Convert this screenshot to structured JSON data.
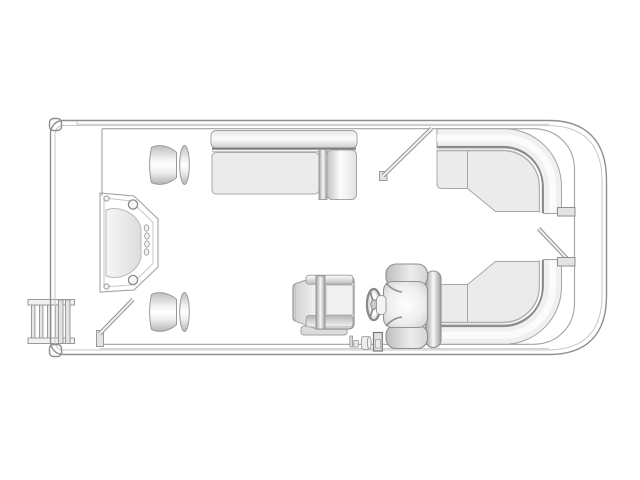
{
  "title": "Pontoon boat deck floor plan (top-down line drawing)",
  "colors": {
    "background": "#ffffff",
    "deck": "#e8e9ea",
    "outline": "#8f8f8f",
    "outline_light": "#c6c8ca",
    "fence": "#a2a2a2",
    "seam": "#8a8a8a",
    "seat": "#ebebec",
    "cushion_base": "#f0f0f0",
    "cushion_highlight": "#fbfbfb",
    "panel": "#e3e3e3"
  },
  "components": [
    {
      "name": "hull",
      "desc": "pontoon deck outline, bow at left, stern at right"
    },
    {
      "name": "boarding-ladder",
      "desc": "four-rung boarding ladder outside bow port corner"
    },
    {
      "name": "bow-gate-door",
      "desc": "bow gate panel with hinge bolts and vent slots"
    },
    {
      "name": "bow-gate-open",
      "desc": "open gate shown swung at starboard bow"
    },
    {
      "name": "pedestal-table-forward",
      "desc": "pedestal seat/table, forward"
    },
    {
      "name": "pedestal-table-aft",
      "desc": "pedestal seat/table, aft of bow door"
    },
    {
      "name": "port-bench-lounge",
      "desc": "straight bench with chaise end along forward port side"
    },
    {
      "name": "port-aft-gate-open",
      "desc": "open side gate ahead of stern lounge"
    },
    {
      "name": "stern-lounge-top",
      "desc": "wraparound corner lounge, stern port quarter"
    },
    {
      "name": "stern-lounge-bottom",
      "desc": "wraparound corner lounge, stern starboard quarter"
    },
    {
      "name": "stern-gate-open",
      "desc": "open stern gate between lounges"
    },
    {
      "name": "helm-console",
      "desc": "helm station with windscreen"
    },
    {
      "name": "steering-wheel",
      "desc": "steering wheel with three spokes"
    },
    {
      "name": "captains-chair",
      "desc": "captain's swivel chair facing helm"
    },
    {
      "name": "deck-fittings",
      "desc": "small deck fittings aft of helm"
    }
  ]
}
